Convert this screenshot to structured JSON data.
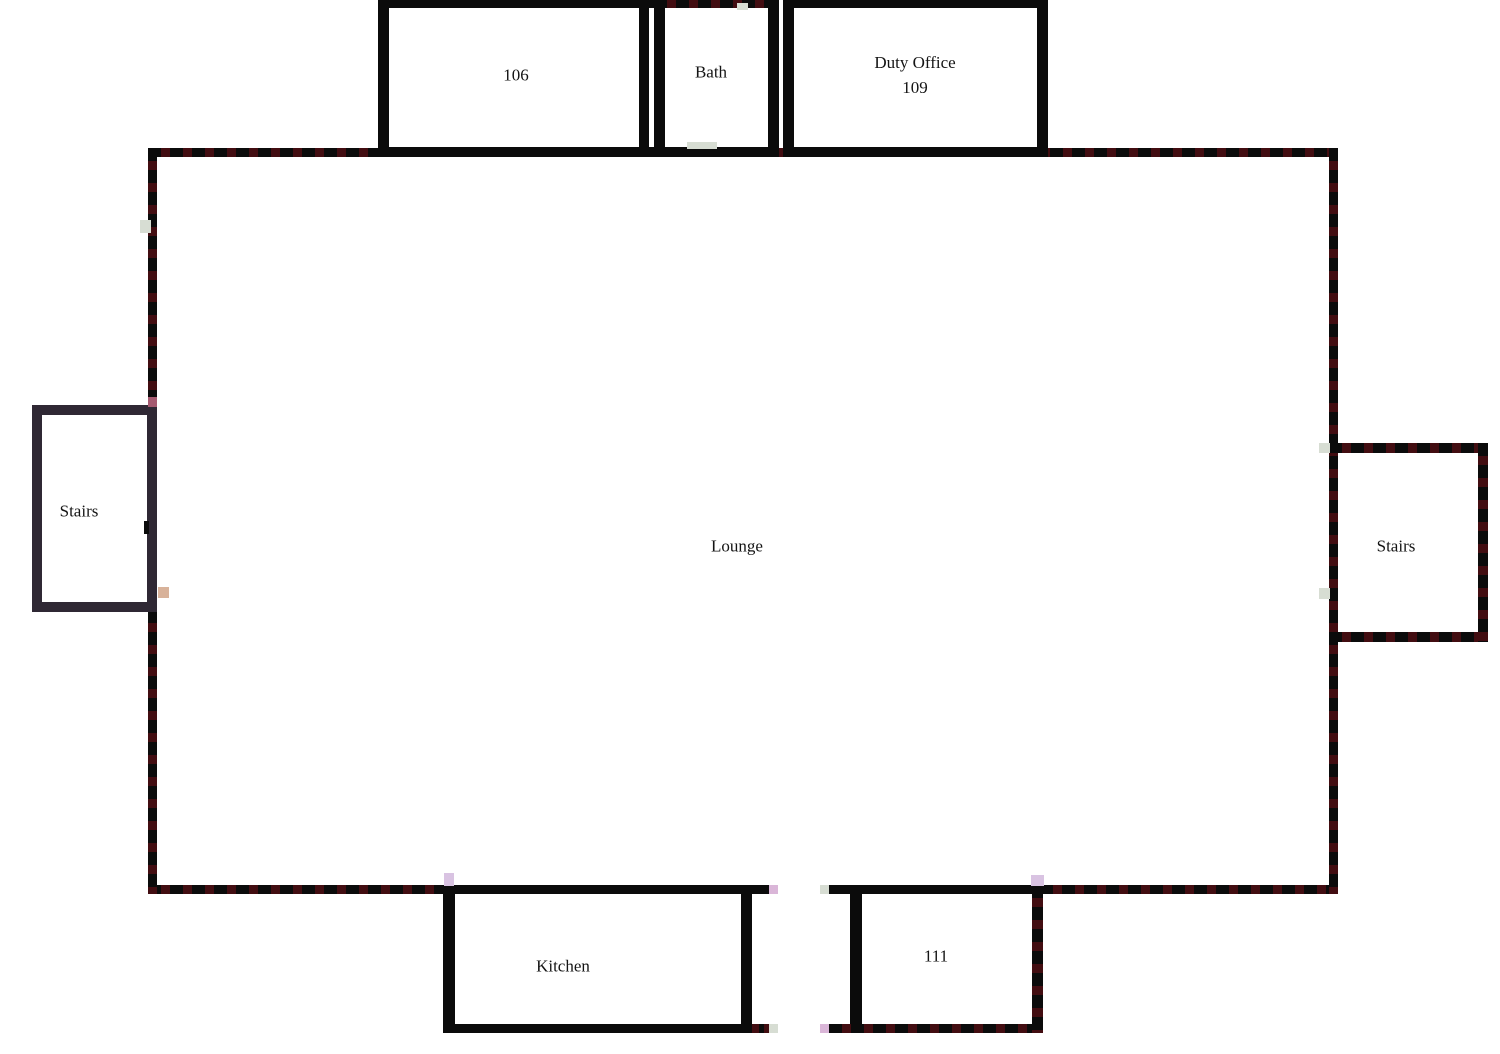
{
  "figure_type": "floor-plan",
  "rooms": {
    "room_106": {
      "label": "106"
    },
    "bath": {
      "label": "Bath"
    },
    "duty_office": {
      "label_line1": "Duty Office",
      "label_line2": "109"
    },
    "lounge": {
      "label": "Lounge"
    },
    "stairs_left": {
      "label": "Stairs"
    },
    "stairs_right": {
      "label": "Stairs"
    },
    "kitchen": {
      "label": "Kitchen"
    },
    "room_111": {
      "label": "111"
    }
  },
  "colors": {
    "wall": "#0b0b0b",
    "wall_dash": "#420d11",
    "stairs_wall": "#2f2834",
    "marker_gray": "#d7ddd3",
    "marker_lavender": "#d9c3e2",
    "marker_pink": "#dab6d8",
    "marker_rose": "#a55a70",
    "marker_tan": "#d8b29a"
  }
}
